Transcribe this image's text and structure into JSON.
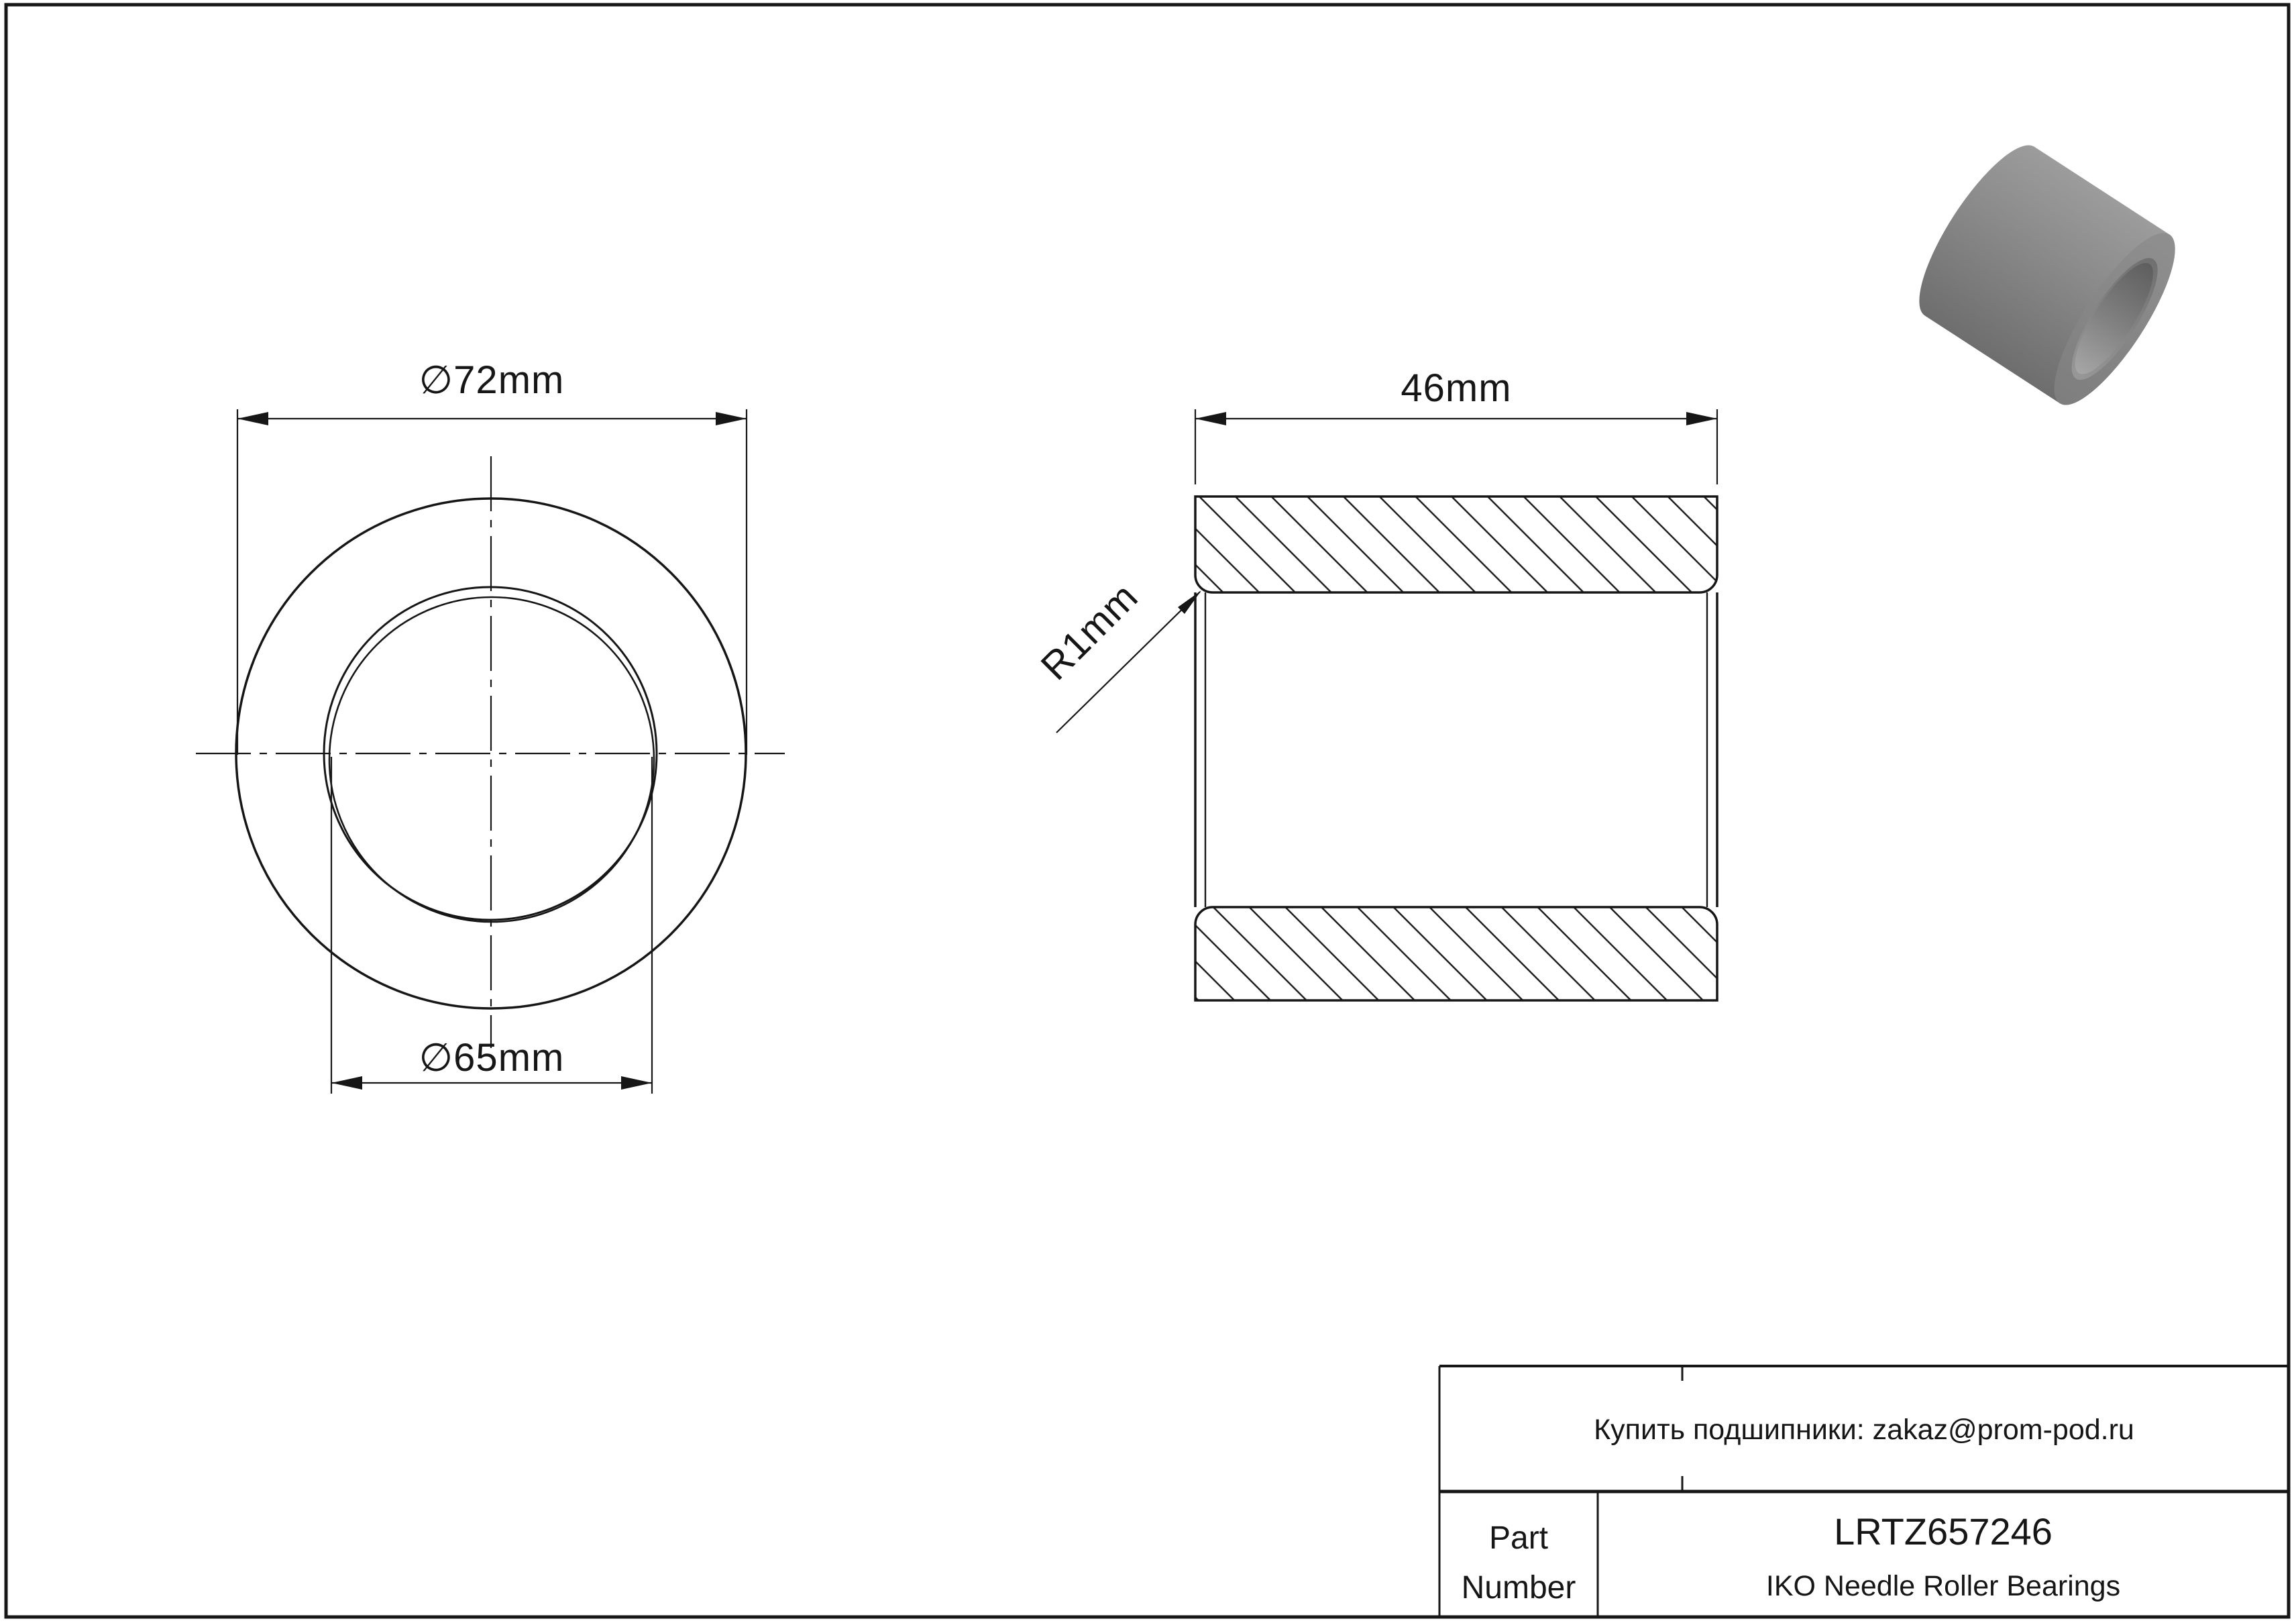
{
  "drawing": {
    "type": "engineering-drawing",
    "views": {
      "front_view": {
        "outer_diameter_label": "∅72mm",
        "bore_diameter_label": "∅65mm",
        "outer_diameter_mm": 72,
        "bore_diameter_mm": 65
      },
      "section_view": {
        "width_label": "46mm",
        "width_mm": 46,
        "fillet_label": "R1mm",
        "fillet_radius_mm": 1
      }
    },
    "title_block": {
      "contact_line": "Купить подшипники: zakaz@prom-pod.ru",
      "part_label_line1": "Part",
      "part_label_line2": "Number",
      "part_number": "LRTZ657246",
      "brand_line": "IKO Needle Roller Bearings"
    },
    "colors": {
      "line": "#161616",
      "paper": "#ffffff",
      "model_body_light": "#9c9c9c",
      "model_body_dark": "#6e6e6e",
      "model_face": "#868686",
      "model_bore_dark": "#5e5e5e",
      "model_bore_light": "#a6a6a6"
    }
  }
}
